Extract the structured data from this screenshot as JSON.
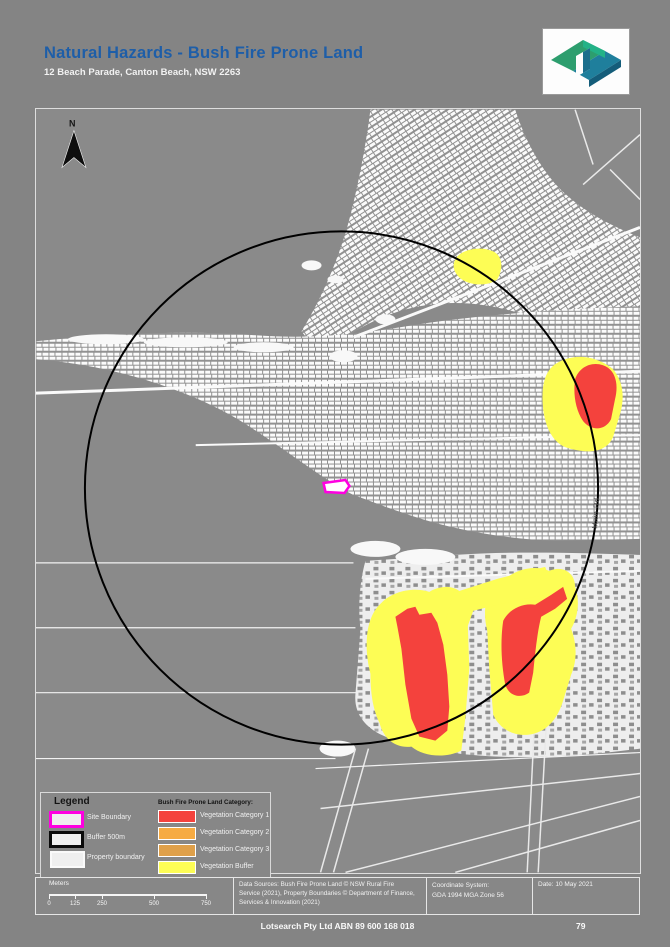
{
  "header": {
    "title": "Natural Hazards - Bush Fire Prone Land",
    "subtitle": "12 Beach Parade, Canton Beach, NSW 2263",
    "title_color": "#1e5ea8",
    "logo_name": "lotsearch-logo"
  },
  "map": {
    "north_label": "N",
    "road_label": "Main Rd",
    "colors": {
      "background": "#8a8a8a",
      "buffer_circle": "#000000",
      "site_boundary": "#ff00e1",
      "veg_cat1": "#f4423d",
      "veg_cat2": "#f6ab42",
      "veg_cat3": "#dfa04a",
      "veg_buffer": "#fdfd55"
    }
  },
  "legend": {
    "title": "Legend",
    "items": [
      {
        "label": "Site Boundary",
        "color": "#ff00e1"
      },
      {
        "label": "Buffer 500m",
        "color": "#0a0a0a"
      },
      {
        "label": "Property boundary",
        "color": "#fafafa"
      }
    ],
    "category_title": "Bush Fire Prone Land Category:",
    "categories": [
      {
        "label": "Vegetation Category 1",
        "color": "#f4423d"
      },
      {
        "label": "Vegetation Category 2",
        "color": "#f6ab42"
      },
      {
        "label": "Vegetation Category 3",
        "color": "#dfa04a"
      },
      {
        "label": "Vegetation Buffer",
        "color": "#fdfd55"
      }
    ]
  },
  "scalebar": {
    "unit_label": "Meters",
    "ticks": [
      "0",
      "125",
      "250",
      "500",
      "750"
    ]
  },
  "info_boxes": {
    "attribution_line1": "Data Sources: Bush Fire Prone Land © NSW Rural Fire",
    "attribution_line2": "Service (2021), Property Boundaries © Department of Finance,",
    "attribution_line3": "Services & Innovation (2021)",
    "coordinate_system_label": "Coordinate System:",
    "coordinate_system_value": "GDA 1994 MGA Zone 56",
    "date": "Date: 10 May 2021"
  },
  "footer": {
    "company_line": "Lotsearch Pty Ltd ABN 89 600 168 018",
    "page_number": "79"
  }
}
